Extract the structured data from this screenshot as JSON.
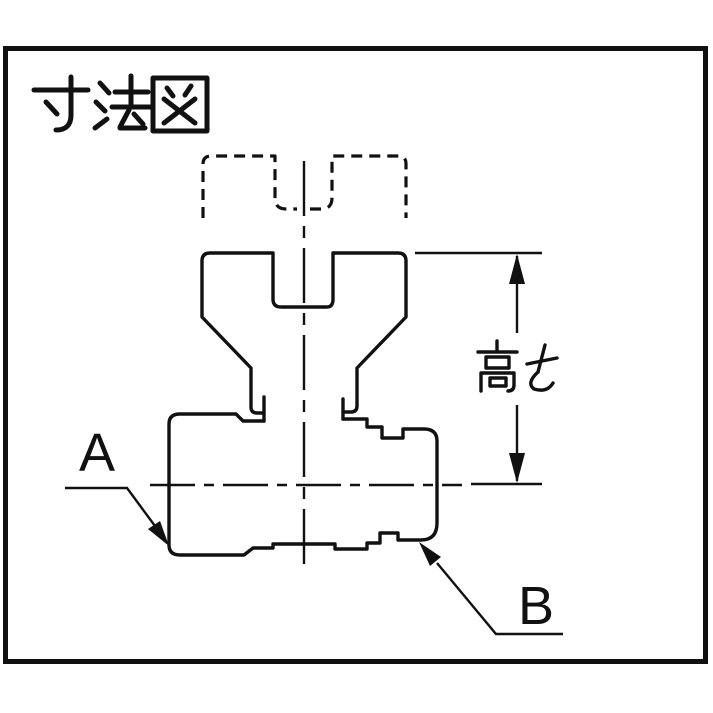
{
  "title": {
    "text": "寸法図"
  },
  "figure": {
    "dimension": {
      "label": "高さ"
    },
    "part_labels": {
      "a": "A",
      "b": "B"
    }
  },
  "colors": {
    "line": "#111111",
    "background": "#ffffff"
  }
}
